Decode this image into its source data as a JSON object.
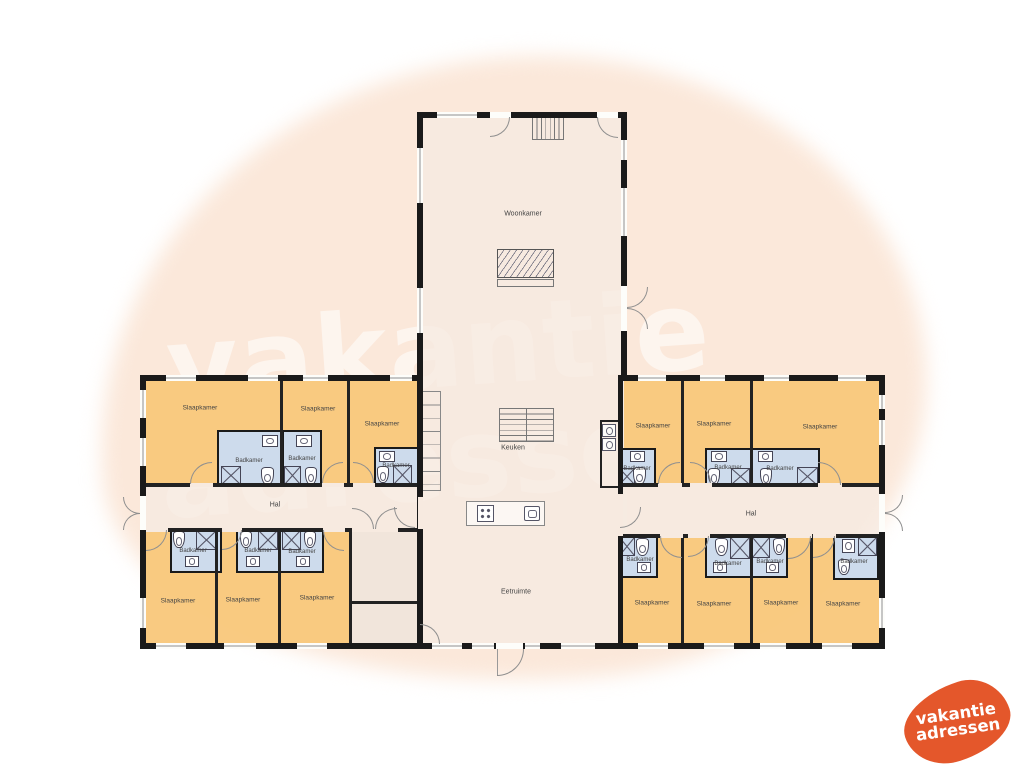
{
  "watermark": {
    "line1": "vakantie",
    "line2": "adressen"
  },
  "logo": {
    "line1": "vakantie",
    "line2": "adressen",
    "color": "#e4572b"
  },
  "colors": {
    "bedroom_fill": "#f9c779",
    "bathroom_fill": "#cbdcf0",
    "floor_fill": "#f6ebe2",
    "wall": "#1a1a1a",
    "background_blob": "#fbe8da",
    "brand_orange": "#e4572b"
  },
  "plan": {
    "floors": [
      [
        417,
        112,
        210,
        537
      ],
      [
        140,
        375,
        282,
        273
      ],
      [
        618,
        375,
        267,
        273
      ],
      [
        600,
        420,
        19,
        68
      ]
    ],
    "beige_rooms": [
      [
        352,
        531,
        65,
        70
      ],
      [
        352,
        603,
        65,
        40
      ]
    ],
    "bedrooms": [
      [
        143,
        378,
        137,
        107
      ],
      [
        283,
        378,
        64,
        107
      ],
      [
        350,
        378,
        67,
        107
      ],
      [
        143,
        531,
        72,
        112
      ],
      [
        218,
        531,
        60,
        112
      ],
      [
        281,
        531,
        68,
        112
      ],
      [
        624,
        378,
        57,
        107
      ],
      [
        684,
        378,
        66,
        107
      ],
      [
        753,
        378,
        126,
        107
      ],
      [
        621,
        537,
        60,
        106
      ],
      [
        684,
        537,
        66,
        106
      ],
      [
        753,
        537,
        57,
        106
      ],
      [
        813,
        537,
        66,
        106
      ]
    ],
    "baths": [
      [
        217,
        430,
        65,
        56
      ],
      [
        282,
        430,
        40,
        56
      ],
      [
        374,
        447,
        45,
        39
      ],
      [
        170,
        528,
        52,
        45
      ],
      [
        236,
        528,
        45,
        45
      ],
      [
        279,
        528,
        45,
        45
      ],
      [
        618,
        448,
        38,
        38
      ],
      [
        705,
        448,
        47,
        38
      ],
      [
        750,
        448,
        70,
        38
      ],
      [
        618,
        535,
        40,
        43
      ],
      [
        705,
        535,
        47,
        43
      ],
      [
        750,
        535,
        38,
        43
      ],
      [
        833,
        535,
        46,
        45
      ]
    ],
    "fixtures": {
      "island": [
        [
          466,
          501,
          79,
          25
        ]
      ],
      "cabinets": [
        [
          421,
          391,
          20,
          100
        ]
      ],
      "stairs_v": [
        [
          532,
          115,
          32,
          25
        ]
      ],
      "stairs_grid": [
        [
          499,
          408,
          55,
          34
        ]
      ],
      "fireplace": [
        [
          497,
          249,
          57,
          29
        ]
      ],
      "hearth": [
        [
          497,
          279,
          57,
          8
        ]
      ],
      "shower": [
        [
          221,
          466,
          20,
          19
        ],
        [
          284,
          466,
          17,
          19
        ],
        [
          393,
          465,
          19,
          20
        ],
        [
          196,
          530,
          21,
          20
        ],
        [
          258,
          530,
          20,
          20
        ],
        [
          282,
          530,
          19,
          20
        ],
        [
          619,
          468,
          16,
          17
        ],
        [
          731,
          468,
          19,
          17
        ],
        [
          797,
          467,
          21,
          19
        ],
        [
          619,
          537,
          16,
          19
        ],
        [
          730,
          537,
          20,
          22
        ],
        [
          752,
          537,
          18,
          21
        ],
        [
          858,
          537,
          19,
          19
        ]
      ],
      "toilet": [
        [
          261,
          467,
          13,
          18
        ],
        [
          305,
          467,
          12,
          18
        ],
        [
          377,
          466,
          12,
          17
        ],
        [
          173,
          531,
          12,
          17
        ],
        [
          240,
          531,
          12,
          17
        ],
        [
          304,
          531,
          12,
          17
        ],
        [
          633,
          467,
          13,
          18
        ],
        [
          708,
          468,
          12,
          17
        ],
        [
          760,
          468,
          12,
          17
        ],
        [
          636,
          538,
          13,
          18
        ],
        [
          715,
          538,
          13,
          18
        ],
        [
          773,
          538,
          12,
          17
        ],
        [
          838,
          559,
          12,
          16
        ]
      ],
      "sink": [
        [
          262,
          435,
          16,
          12
        ],
        [
          296,
          435,
          16,
          12
        ],
        [
          379,
          451,
          16,
          11
        ],
        [
          185,
          556,
          14,
          11
        ],
        [
          246,
          556,
          14,
          11
        ],
        [
          296,
          556,
          14,
          11
        ],
        [
          630,
          451,
          15,
          11
        ],
        [
          711,
          451,
          16,
          11
        ],
        [
          758,
          451,
          15,
          11
        ],
        [
          637,
          562,
          14,
          11
        ],
        [
          713,
          562,
          14,
          11
        ],
        [
          766,
          562,
          13,
          11
        ],
        [
          842,
          539,
          13,
          14
        ]
      ],
      "stove": [
        [
          477,
          505,
          17,
          17
        ]
      ],
      "ksink": [
        [
          524,
          506,
          16,
          15
        ]
      ],
      "appl": [
        [
          602,
          424,
          14,
          13
        ],
        [
          602,
          438,
          14,
          13
        ]
      ]
    },
    "iwalls": [
      [
        280,
        375,
        3,
        110
      ],
      [
        347,
        375,
        3,
        110
      ],
      [
        140,
        483,
        282,
        4
      ],
      [
        140,
        528,
        282,
        4
      ],
      [
        215,
        530,
        3,
        113
      ],
      [
        278,
        530,
        3,
        113
      ],
      [
        349,
        528,
        3,
        115
      ],
      [
        352,
        601,
        65,
        3
      ],
      [
        681,
        375,
        3,
        110
      ],
      [
        750,
        375,
        3,
        110
      ],
      [
        618,
        483,
        267,
        4
      ],
      [
        618,
        534,
        267,
        4
      ],
      [
        681,
        537,
        3,
        106
      ],
      [
        750,
        537,
        3,
        106
      ],
      [
        810,
        537,
        3,
        106
      ],
      [
        600,
        420,
        2,
        68
      ],
      [
        600,
        420,
        18,
        2
      ],
      [
        600,
        486,
        18,
        2
      ]
    ],
    "walls": [
      [
        417,
        112,
        210,
        6
      ],
      [
        417,
        112,
        6,
        537
      ],
      [
        621,
        112,
        6,
        266
      ],
      [
        417,
        643,
        210,
        6
      ],
      [
        140,
        375,
        282,
        6
      ],
      [
        140,
        375,
        6,
        274
      ],
      [
        140,
        643,
        283,
        6
      ],
      [
        618,
        375,
        267,
        6
      ],
      [
        879,
        375,
        6,
        274
      ],
      [
        618,
        643,
        267,
        6
      ],
      [
        618,
        375,
        5,
        274
      ]
    ],
    "gaps": [
      [
        418,
        497,
        5,
        32
      ],
      [
        618,
        494,
        5,
        42
      ],
      [
        190,
        483,
        23,
        4
      ],
      [
        322,
        483,
        22,
        4
      ],
      [
        353,
        483,
        22,
        4
      ],
      [
        146,
        528,
        22,
        4
      ],
      [
        222,
        528,
        20,
        4
      ],
      [
        323,
        528,
        22,
        4
      ],
      [
        352,
        528,
        46,
        4
      ],
      [
        658,
        483,
        24,
        4
      ],
      [
        690,
        483,
        22,
        4
      ],
      [
        818,
        483,
        24,
        4
      ],
      [
        660,
        534,
        23,
        4
      ],
      [
        688,
        534,
        22,
        4
      ],
      [
        786,
        534,
        26,
        4
      ],
      [
        813,
        534,
        23,
        4
      ]
    ],
    "wgaps": [
      [
        140,
        496,
        6,
        34
      ],
      [
        879,
        494,
        6,
        38
      ],
      [
        621,
        286,
        6,
        45
      ],
      [
        496,
        643,
        27,
        6
      ],
      [
        490,
        112,
        21,
        6
      ],
      [
        597,
        112,
        21,
        6
      ]
    ],
    "windows": [
      [
        166,
        375,
        30,
        6
      ],
      [
        248,
        375,
        30,
        6
      ],
      [
        303,
        375,
        25,
        6
      ],
      [
        390,
        375,
        22,
        6
      ],
      [
        156,
        643,
        30,
        6
      ],
      [
        224,
        643,
        32,
        6
      ],
      [
        297,
        643,
        30,
        6
      ],
      [
        638,
        375,
        28,
        6
      ],
      [
        700,
        375,
        25,
        6
      ],
      [
        764,
        375,
        25,
        6
      ],
      [
        838,
        375,
        28,
        6
      ],
      [
        638,
        643,
        30,
        6
      ],
      [
        704,
        643,
        30,
        6
      ],
      [
        760,
        643,
        26,
        6
      ],
      [
        822,
        643,
        30,
        6
      ],
      [
        437,
        112,
        40,
        6
      ],
      [
        432,
        643,
        30,
        6
      ],
      [
        472,
        643,
        22,
        6
      ],
      [
        525,
        643,
        15,
        6
      ],
      [
        561,
        643,
        34,
        6
      ],
      [
        140,
        390,
        6,
        28
      ],
      [
        140,
        438,
        6,
        28
      ],
      [
        140,
        598,
        6,
        30
      ],
      [
        879,
        395,
        6,
        14
      ],
      [
        879,
        420,
        6,
        25
      ],
      [
        879,
        598,
        6,
        30
      ],
      [
        417,
        148,
        6,
        55
      ],
      [
        417,
        288,
        6,
        45
      ],
      [
        621,
        140,
        6,
        20
      ],
      [
        621,
        188,
        6,
        48
      ]
    ],
    "doors": [
      [
        490,
        117,
        20,
        20,
        "tl"
      ],
      [
        597,
        117,
        21,
        21,
        "tr"
      ],
      [
        627,
        287,
        21,
        21,
        "tl"
      ],
      [
        627,
        308,
        21,
        21,
        "bl"
      ],
      [
        497,
        649,
        27,
        27,
        "tl"
      ],
      [
        123,
        497,
        17,
        17,
        "tr"
      ],
      [
        123,
        513,
        17,
        17,
        "br"
      ],
      [
        885,
        495,
        18,
        18,
        "tl"
      ],
      [
        885,
        513,
        18,
        18,
        "bl"
      ],
      [
        394,
        507,
        21,
        21,
        "tr"
      ],
      [
        620,
        507,
        21,
        21,
        "tl"
      ],
      [
        352,
        508,
        22,
        21,
        "bl"
      ],
      [
        375,
        508,
        22,
        21,
        "br"
      ],
      [
        190,
        462,
        22,
        22,
        "br"
      ],
      [
        322,
        462,
        21,
        21,
        "br"
      ],
      [
        353,
        462,
        21,
        21,
        "bl"
      ],
      [
        658,
        462,
        22,
        22,
        "br"
      ],
      [
        690,
        462,
        21,
        21,
        "bl"
      ],
      [
        818,
        462,
        23,
        23,
        "bl"
      ],
      [
        146,
        530,
        21,
        21,
        "tl"
      ],
      [
        222,
        530,
        20,
        20,
        "tl"
      ],
      [
        323,
        530,
        21,
        21,
        "tr"
      ],
      [
        660,
        536,
        22,
        22,
        "tr"
      ],
      [
        688,
        536,
        21,
        21,
        "tl"
      ],
      [
        788,
        536,
        23,
        23,
        "tl"
      ],
      [
        813,
        536,
        22,
        22,
        "tl"
      ],
      [
        420,
        624,
        20,
        20,
        "bl"
      ]
    ],
    "leaves": [
      [
        497,
        649,
        1,
        27
      ]
    ],
    "labels": [
      {
        "t": "Woonkamer",
        "x": 523,
        "y": 214,
        "s": "lg"
      },
      {
        "t": "Keuken",
        "x": 513,
        "y": 448,
        "s": "lg"
      },
      {
        "t": "Eetruimte",
        "x": 516,
        "y": 592,
        "s": "lg"
      },
      {
        "t": "Hal",
        "x": 275,
        "y": 505,
        "s": "lg"
      },
      {
        "t": "Hal",
        "x": 751,
        "y": 514,
        "s": "lg"
      },
      {
        "t": "Slaapkamer",
        "x": 200,
        "y": 408,
        "s": "md"
      },
      {
        "t": "Slaapkamer",
        "x": 318,
        "y": 409,
        "s": "md"
      },
      {
        "t": "Slaapkamer",
        "x": 382,
        "y": 424,
        "s": "md"
      },
      {
        "t": "Slaapkamer",
        "x": 178,
        "y": 601,
        "s": "md"
      },
      {
        "t": "Slaapkamer",
        "x": 243,
        "y": 600,
        "s": "md"
      },
      {
        "t": "Slaapkamer",
        "x": 317,
        "y": 598,
        "s": "md"
      },
      {
        "t": "Slaapkamer",
        "x": 653,
        "y": 426,
        "s": "md"
      },
      {
        "t": "Slaapkamer",
        "x": 714,
        "y": 424,
        "s": "md"
      },
      {
        "t": "Slaapkamer",
        "x": 820,
        "y": 427,
        "s": "md"
      },
      {
        "t": "Slaapkamer",
        "x": 652,
        "y": 603,
        "s": "md"
      },
      {
        "t": "Slaapkamer",
        "x": 714,
        "y": 604,
        "s": "md"
      },
      {
        "t": "Slaapkamer",
        "x": 781,
        "y": 603,
        "s": "md"
      },
      {
        "t": "Slaapkamer",
        "x": 843,
        "y": 604,
        "s": "md"
      },
      {
        "t": "Badkamer",
        "x": 249,
        "y": 461,
        "s": "sm"
      },
      {
        "t": "Badkamer",
        "x": 302,
        "y": 459,
        "s": "sm"
      },
      {
        "t": "Badkamer",
        "x": 396,
        "y": 466,
        "s": "sm"
      },
      {
        "t": "Badkamer",
        "x": 193,
        "y": 551,
        "s": "sm"
      },
      {
        "t": "Badkamer",
        "x": 258,
        "y": 551,
        "s": "sm"
      },
      {
        "t": "Badkamer",
        "x": 302,
        "y": 552,
        "s": "sm"
      },
      {
        "t": "Badkamer",
        "x": 637,
        "y": 469,
        "s": "sm"
      },
      {
        "t": "Badkamer",
        "x": 728,
        "y": 468,
        "s": "sm"
      },
      {
        "t": "Badkamer",
        "x": 780,
        "y": 469,
        "s": "sm"
      },
      {
        "t": "Badkamer",
        "x": 640,
        "y": 560,
        "s": "sm"
      },
      {
        "t": "Badkamer",
        "x": 728,
        "y": 564,
        "s": "sm"
      },
      {
        "t": "Badkamer",
        "x": 770,
        "y": 562,
        "s": "sm"
      },
      {
        "t": "Badkamer",
        "x": 854,
        "y": 562,
        "s": "sm"
      }
    ]
  }
}
